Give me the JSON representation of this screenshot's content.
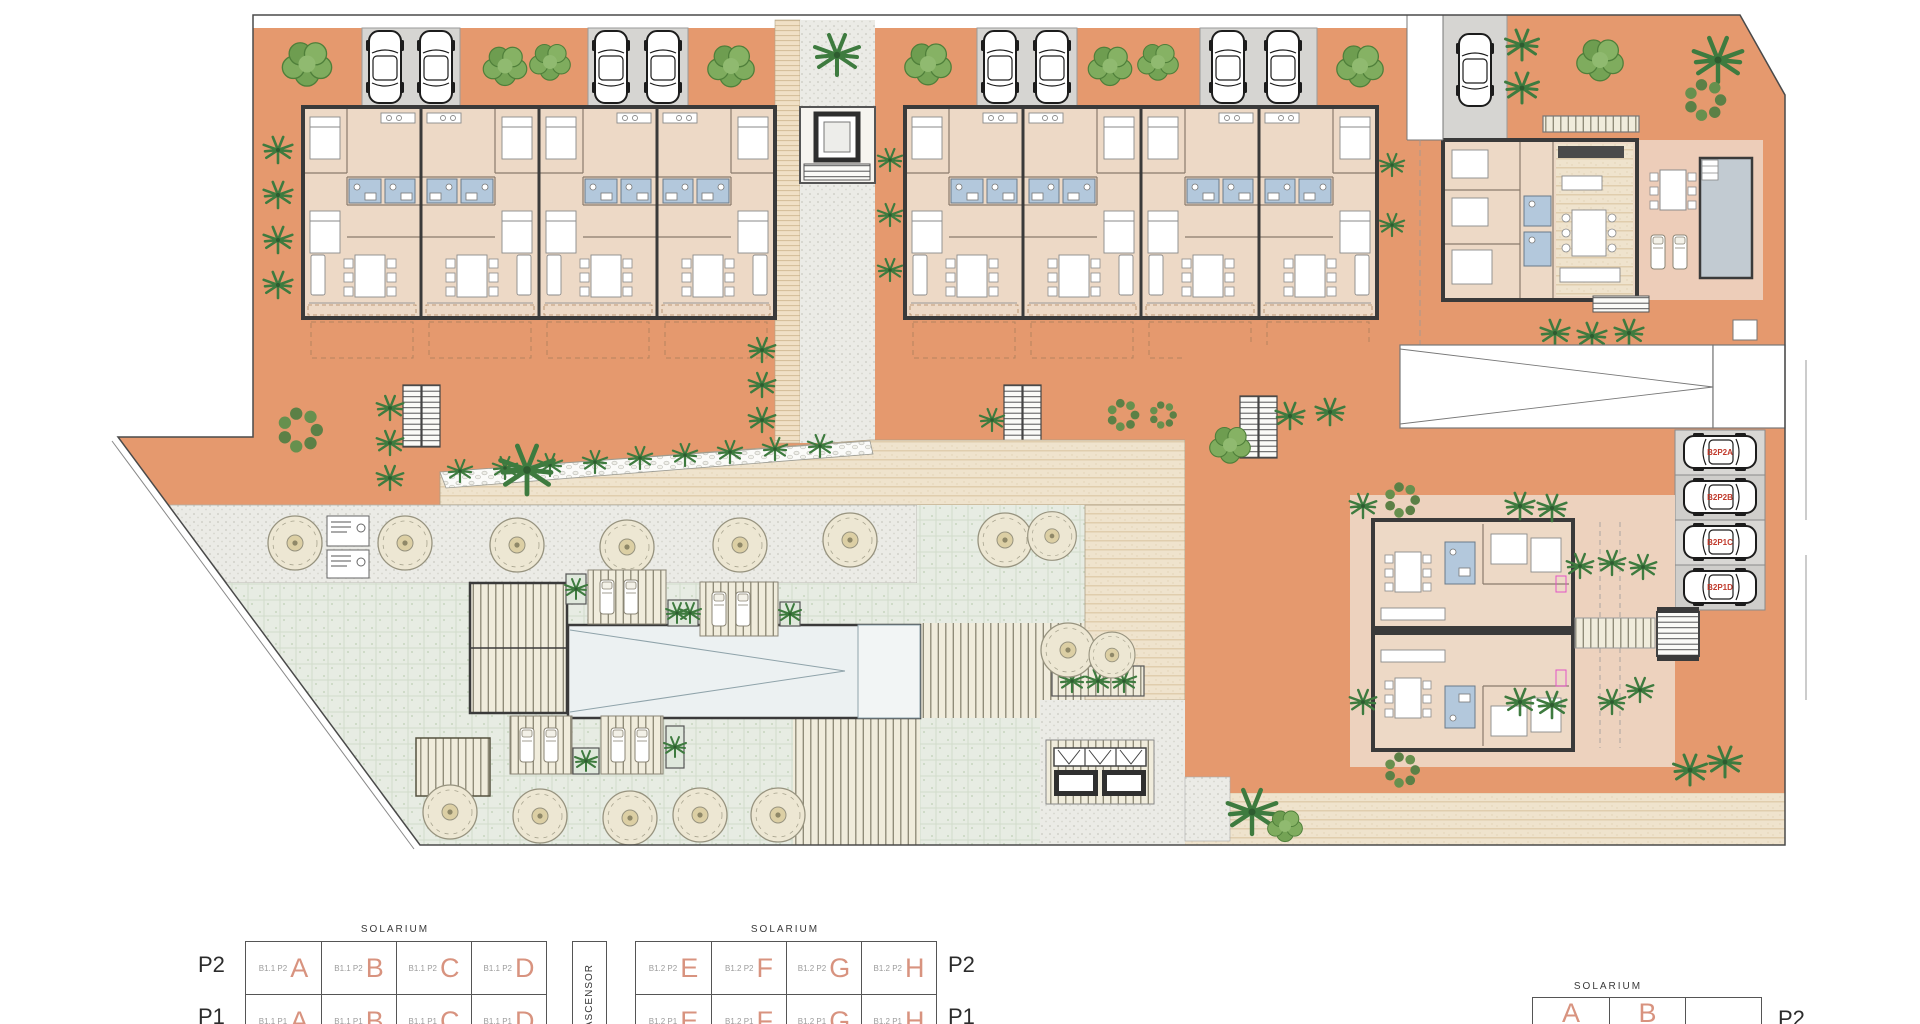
{
  "legend": {
    "solarium": "SOLARIUM",
    "ascensor": "ASCENSOR",
    "left_labels": {
      "p2": "P2",
      "p1": "P1"
    },
    "right_labels": {
      "p2": "P2",
      "p1": "P1"
    },
    "far_label": "P2",
    "t1": {
      "p2": [
        {
          "prefix": "B1.1 P2",
          "letter": "A"
        },
        {
          "prefix": "B1.1 P2",
          "letter": "B"
        },
        {
          "prefix": "B1.1 P2",
          "letter": "C"
        },
        {
          "prefix": "B1.1 P2",
          "letter": "D"
        }
      ],
      "p1": [
        {
          "prefix": "B1.1 P1",
          "letter": "A"
        },
        {
          "prefix": "B1.1 P1",
          "letter": "B"
        },
        {
          "prefix": "B1.1 P1",
          "letter": "C"
        },
        {
          "prefix": "B1.1 P1",
          "letter": "D"
        }
      ]
    },
    "t2": {
      "p2": [
        {
          "prefix": "B1.2 P2",
          "letter": "E"
        },
        {
          "prefix": "B1.2 P2",
          "letter": "F"
        },
        {
          "prefix": "B1.2 P2",
          "letter": "G"
        },
        {
          "prefix": "B1.2 P2",
          "letter": "H"
        }
      ],
      "p1": [
        {
          "prefix": "B1.2 P1",
          "letter": "E"
        },
        {
          "prefix": "B1.2 P1",
          "letter": "F"
        },
        {
          "prefix": "B1.2 P1",
          "letter": "G"
        },
        {
          "prefix": "B1.2 P1",
          "letter": "H"
        }
      ]
    },
    "t3": {
      "letters": [
        "A",
        "B",
        ""
      ]
    }
  },
  "parking": {
    "spaces": [
      {
        "label": "B2P2A"
      },
      {
        "label": "B2P2B"
      },
      {
        "label": "B2P1C"
      },
      {
        "label": "B2P1D"
      }
    ]
  },
  "colors": {
    "terrace_orange": "#E5996E",
    "pale_terrace": "#EDD2BE",
    "interior_floor": "#EDD9C6",
    "parking_gray": "#D6D5D2",
    "bath_blue": "#B3C8DC",
    "lawn_green": "#E7ECE3",
    "pool_water": "#ECF1F2",
    "villa_pool": "#C2CBD2",
    "tree_green": "#74A355",
    "parking_label_red": "#C0392B",
    "unit_letter_salmon": "#D8937F"
  }
}
